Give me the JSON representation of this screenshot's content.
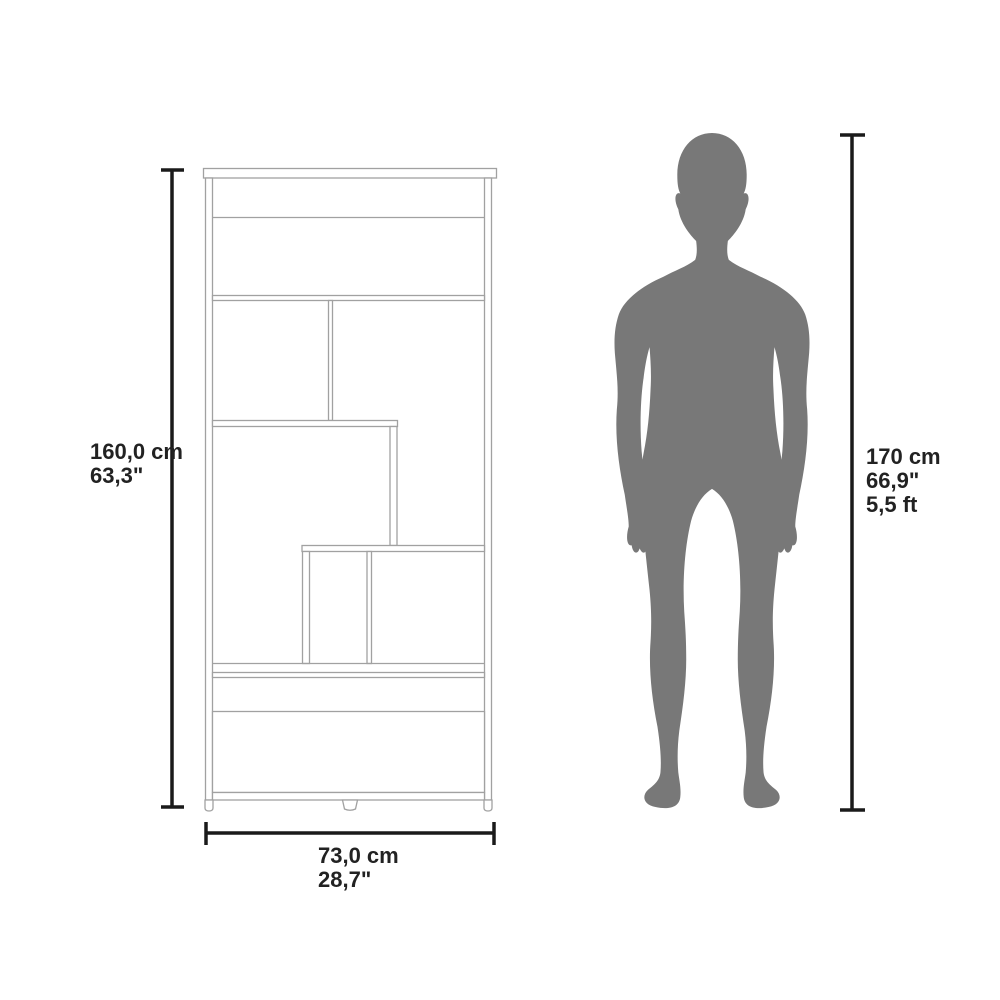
{
  "diagram": {
    "type": "furniture-dimension-diagram",
    "furniture": {
      "name": "staircase bookcase with drawer",
      "height_label": {
        "cm": "160,0 cm",
        "inches": "63,3\""
      },
      "width_label": {
        "cm": "73,0 cm",
        "inches": "28,7\""
      }
    },
    "person": {
      "name": "human silhouette for scale",
      "height_label": {
        "cm": "170 cm",
        "inches": "66,9\"",
        "feet": "5,5 ft"
      }
    },
    "colors": {
      "background": "#ffffff",
      "dimension_line": "#1a1a1a",
      "furniture_line": "#a1a1a1",
      "silhouette": "#787878",
      "text": "#222222"
    }
  }
}
